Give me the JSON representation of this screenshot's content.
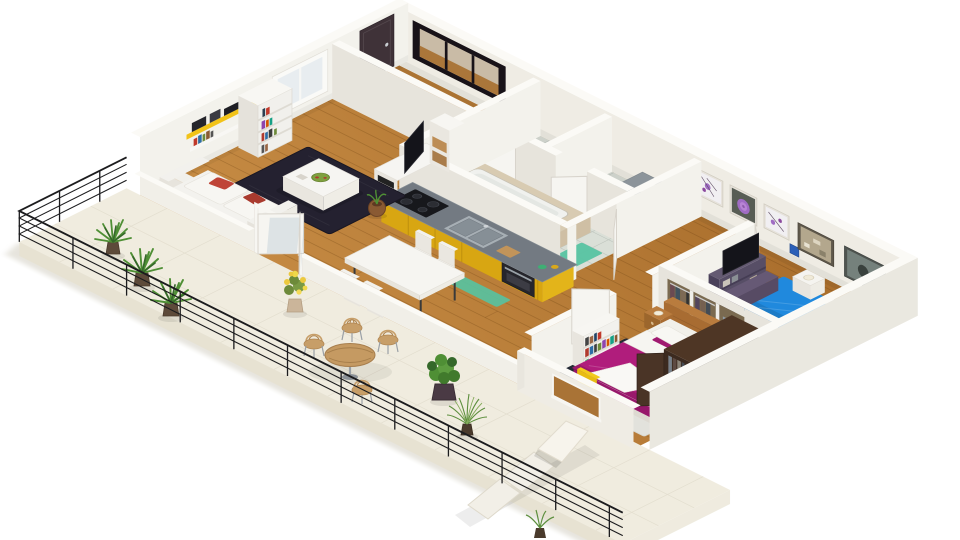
{
  "canvas": {
    "width": 960,
    "height": 540,
    "background": "#ffffff"
  },
  "colors": {
    "background": "#ffffff",
    "wall_face": "#efece4",
    "wall_light": "#f3f2ec",
    "wall_shade": "#e7e4dc",
    "wall_top": "#fbfaf6",
    "wall_outer": "#eae8e0",
    "wood_light": "#c88d45",
    "wood_dark": "#a76c2b",
    "tile": "#dadfd7",
    "balcony_floor": "#f0ecdf",
    "slab_edge": "#e7e2d2",
    "cabinet_yellow": "#d8a612",
    "cabinet_yellow_side": "#e3b41a",
    "countertop": "#737a82",
    "shelf_yellow": "#f2c318",
    "sofa_white": "#f3f2ee",
    "pillow_red": "#bf4437",
    "rug_dark": "#242130",
    "rug_navy": "#232a35",
    "rug_light": "#e2e2dc",
    "tv_black": "#14141a",
    "bed_magenta": "#b01d7c",
    "duvet_white": "#f6f5f1",
    "bed_blue": "#2089dd",
    "headboard_plum": "#5e5270",
    "bed_wood": "#a86c32",
    "wardrobe_brown": "#3c2a1f",
    "chair_yellow": "#f0c517",
    "door_brown": "#3f3238",
    "frame_black": "#181218",
    "art_purple": "#a06cc4",
    "teal_mat": "#57c3a2",
    "plant_green": "#4f8f35",
    "plant_dark": "#35682a",
    "pot_brown": "#6e4526",
    "planter_plum": "#4a3a44",
    "bistro_wood": "#c59a62",
    "metal": "#9aa0a6",
    "railing": "#1c1c1e",
    "doormat": "#9aa2a8",
    "tub_beige": "#d8cbb2"
  },
  "scene": {
    "title": "3D isometric floor plan render of a two-bedroom apartment with wrap-around balcony",
    "rooms": {
      "living": {
        "label": "living room"
      },
      "kitchen": {
        "label": "kitchen"
      },
      "dining": {
        "label": "dining area"
      },
      "bathroom": {
        "label": "bathroom"
      },
      "wc": {
        "label": "toilet room"
      },
      "entry": {
        "label": "entry hall"
      },
      "hallway": {
        "label": "hallway"
      },
      "master_bedroom": {
        "label": "master bedroom"
      },
      "second_bedroom": {
        "label": "second bedroom"
      },
      "closet": {
        "label": "wardrobe closet"
      },
      "balcony": {
        "label": "balcony terrace"
      }
    },
    "objects": [
      "white sofa with red pillows",
      "dark area rug",
      "white coffee table",
      "flat tv on white unit",
      "yellow wall shelves with books and stereo",
      "ladder bookcase",
      "window",
      "french doors",
      "yellow kitchen cabinets with cooktop, sink and oven",
      "white dining table with four chairs",
      "bathtub on beige platform",
      "toilet",
      "washbasin counter",
      "teal bath mats",
      "entry door",
      "black framed mirror",
      "doormat",
      "three purple flower canvases",
      "two framed artworks",
      "small blue picture",
      "magenta double bed with white duvet",
      "wooden headboard with nightstands and lamps",
      "dark brown wardrobe",
      "yellow chair",
      "bookshelf with colorful books",
      "blue single bed",
      "plum headboard and bench",
      "plum tv cabinet",
      "closet shelving with clothes",
      "black metal balcony railing",
      "potted yucca plants",
      "yellow flowering plant",
      "wooden bistro table with chairs",
      "leafy potted plants",
      "cream sun lounger"
    ]
  }
}
